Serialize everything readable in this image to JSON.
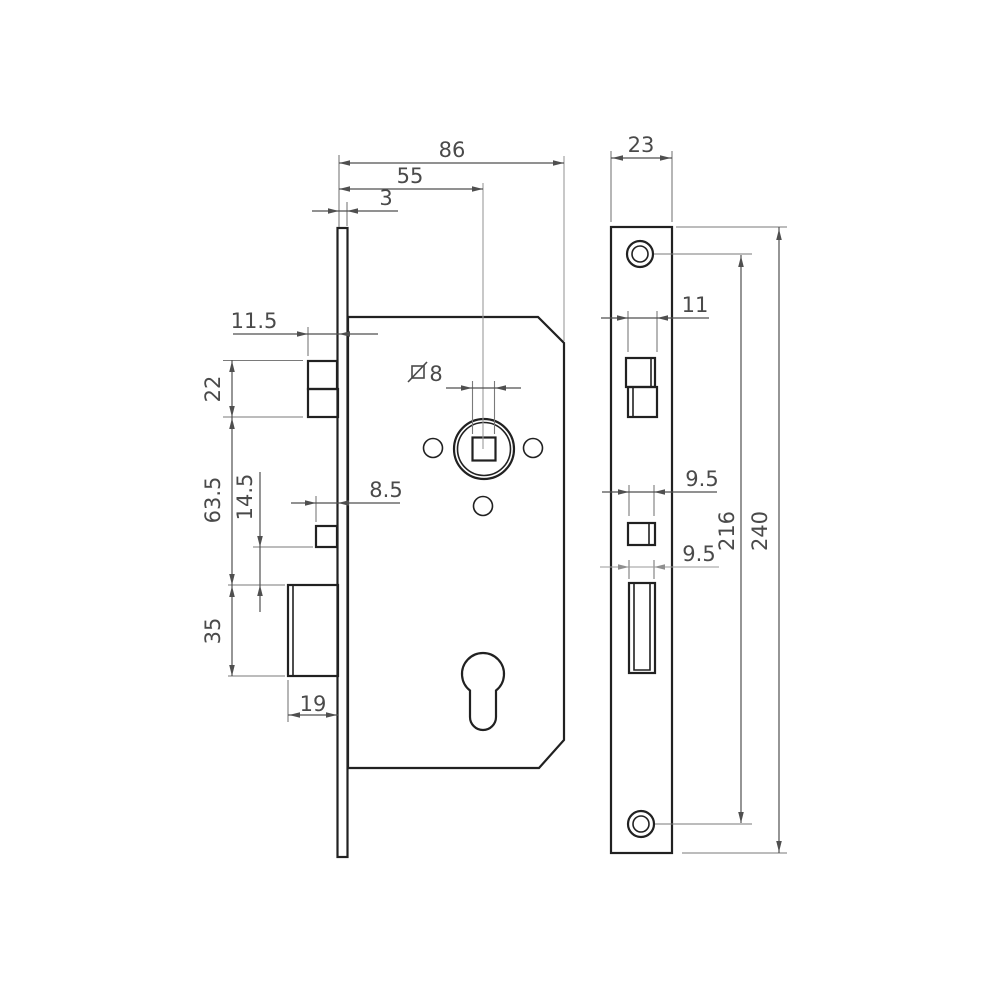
{
  "title": "Mortise lock dimension drawing",
  "units": "mm",
  "colors": {
    "object_line": "#212121",
    "dimension_line": "#4f4f4f",
    "extension_line": "#7a7a7a",
    "centerline": "#9a9a9a",
    "background": "#ffffff"
  },
  "side_view": {
    "label": "lock-case-side-view",
    "dims": {
      "case_width": "86",
      "backset": "55",
      "faceplate_thickness": "3",
      "latch_protrusion": "11.5",
      "latch_height": "22",
      "latch_to_deadbolt": "63.5",
      "follower_offset": "14.5",
      "follower_width": "8.5",
      "spindle_square": "8",
      "deadbolt_height": "35",
      "deadbolt_protrusion": "19"
    }
  },
  "faceplate_view": {
    "label": "faceplate-front-view",
    "dims": {
      "plate_width": "23",
      "latch_cutout_width": "11",
      "follower_cutout_width": "9.5",
      "deadbolt_cutout_width": "9.5",
      "screw_hole_spacing": "216",
      "plate_length": "240"
    }
  }
}
